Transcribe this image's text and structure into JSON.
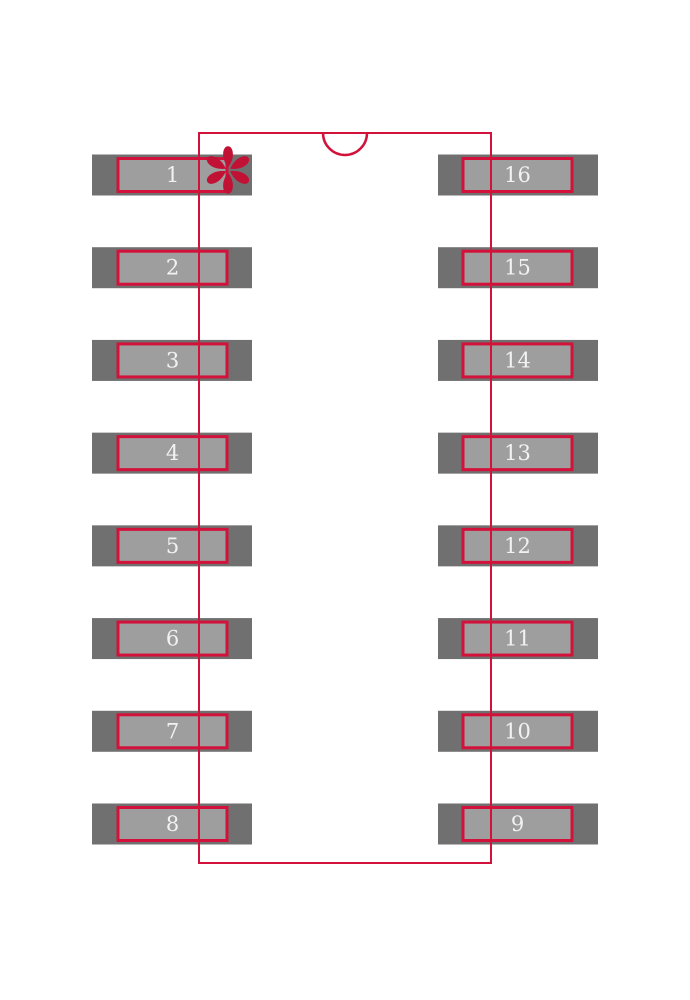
{
  "figure": {
    "name": "ic-footprint-land-pattern",
    "package_style": "16-pin dual-row (SOIC-16) footprint",
    "pin_count": 16
  },
  "footprint": {
    "left_pins": [
      "1",
      "2",
      "3",
      "4",
      "5",
      "6",
      "7",
      "8"
    ],
    "right_pins": [
      "16",
      "15",
      "14",
      "13",
      "12",
      "11",
      "10",
      "9"
    ],
    "pin1_marker": "teardrop-asterisk-icon",
    "orientation_notch": "top-center-semicircle",
    "colors": {
      "background": "#ffffff",
      "pad_outer_gray": "#707070",
      "pad_inner_gray": "#9e9e9e",
      "outline_red": "#d2123a",
      "marker_red": "#c11236",
      "pin_number_text": "#f2f2f2"
    }
  }
}
